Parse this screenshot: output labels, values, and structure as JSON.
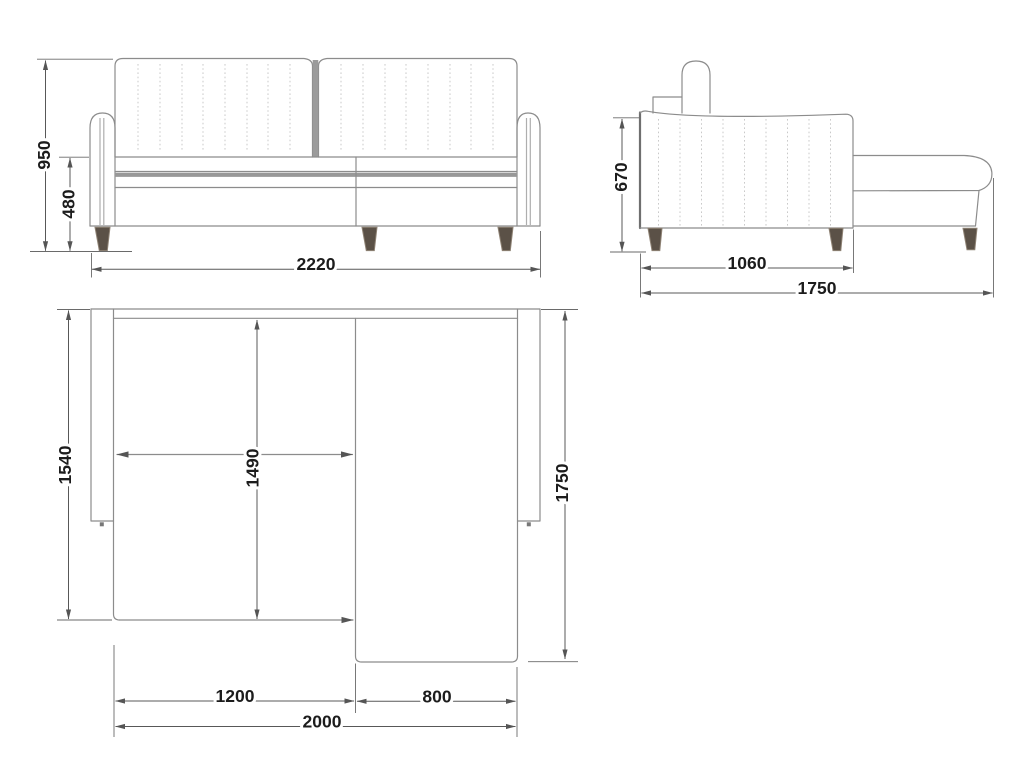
{
  "views": {
    "front": {
      "overall_height": "950",
      "seat_height": "480",
      "overall_width": "2220"
    },
    "side": {
      "backrest_height": "670",
      "body_depth": "1060",
      "overall_depth": "1750"
    },
    "plan": {
      "body_depth": "1540",
      "inner_depth": "1490",
      "chaise_depth": "1750",
      "seat_section_width": "1200",
      "chaise_section_width": "800",
      "inner_width": "2000"
    }
  },
  "colors": {
    "background": "#ffffff",
    "outline": "#8c8c8c",
    "outline_dark": "#6f6f6f",
    "dimension_line": "#585858",
    "label_text": "#1c1c1c",
    "leg_fill": "#5b5147",
    "leg_edge": "#8e8274",
    "tufting": "#c9c9c9",
    "divider_band": "#9b9b9b"
  }
}
